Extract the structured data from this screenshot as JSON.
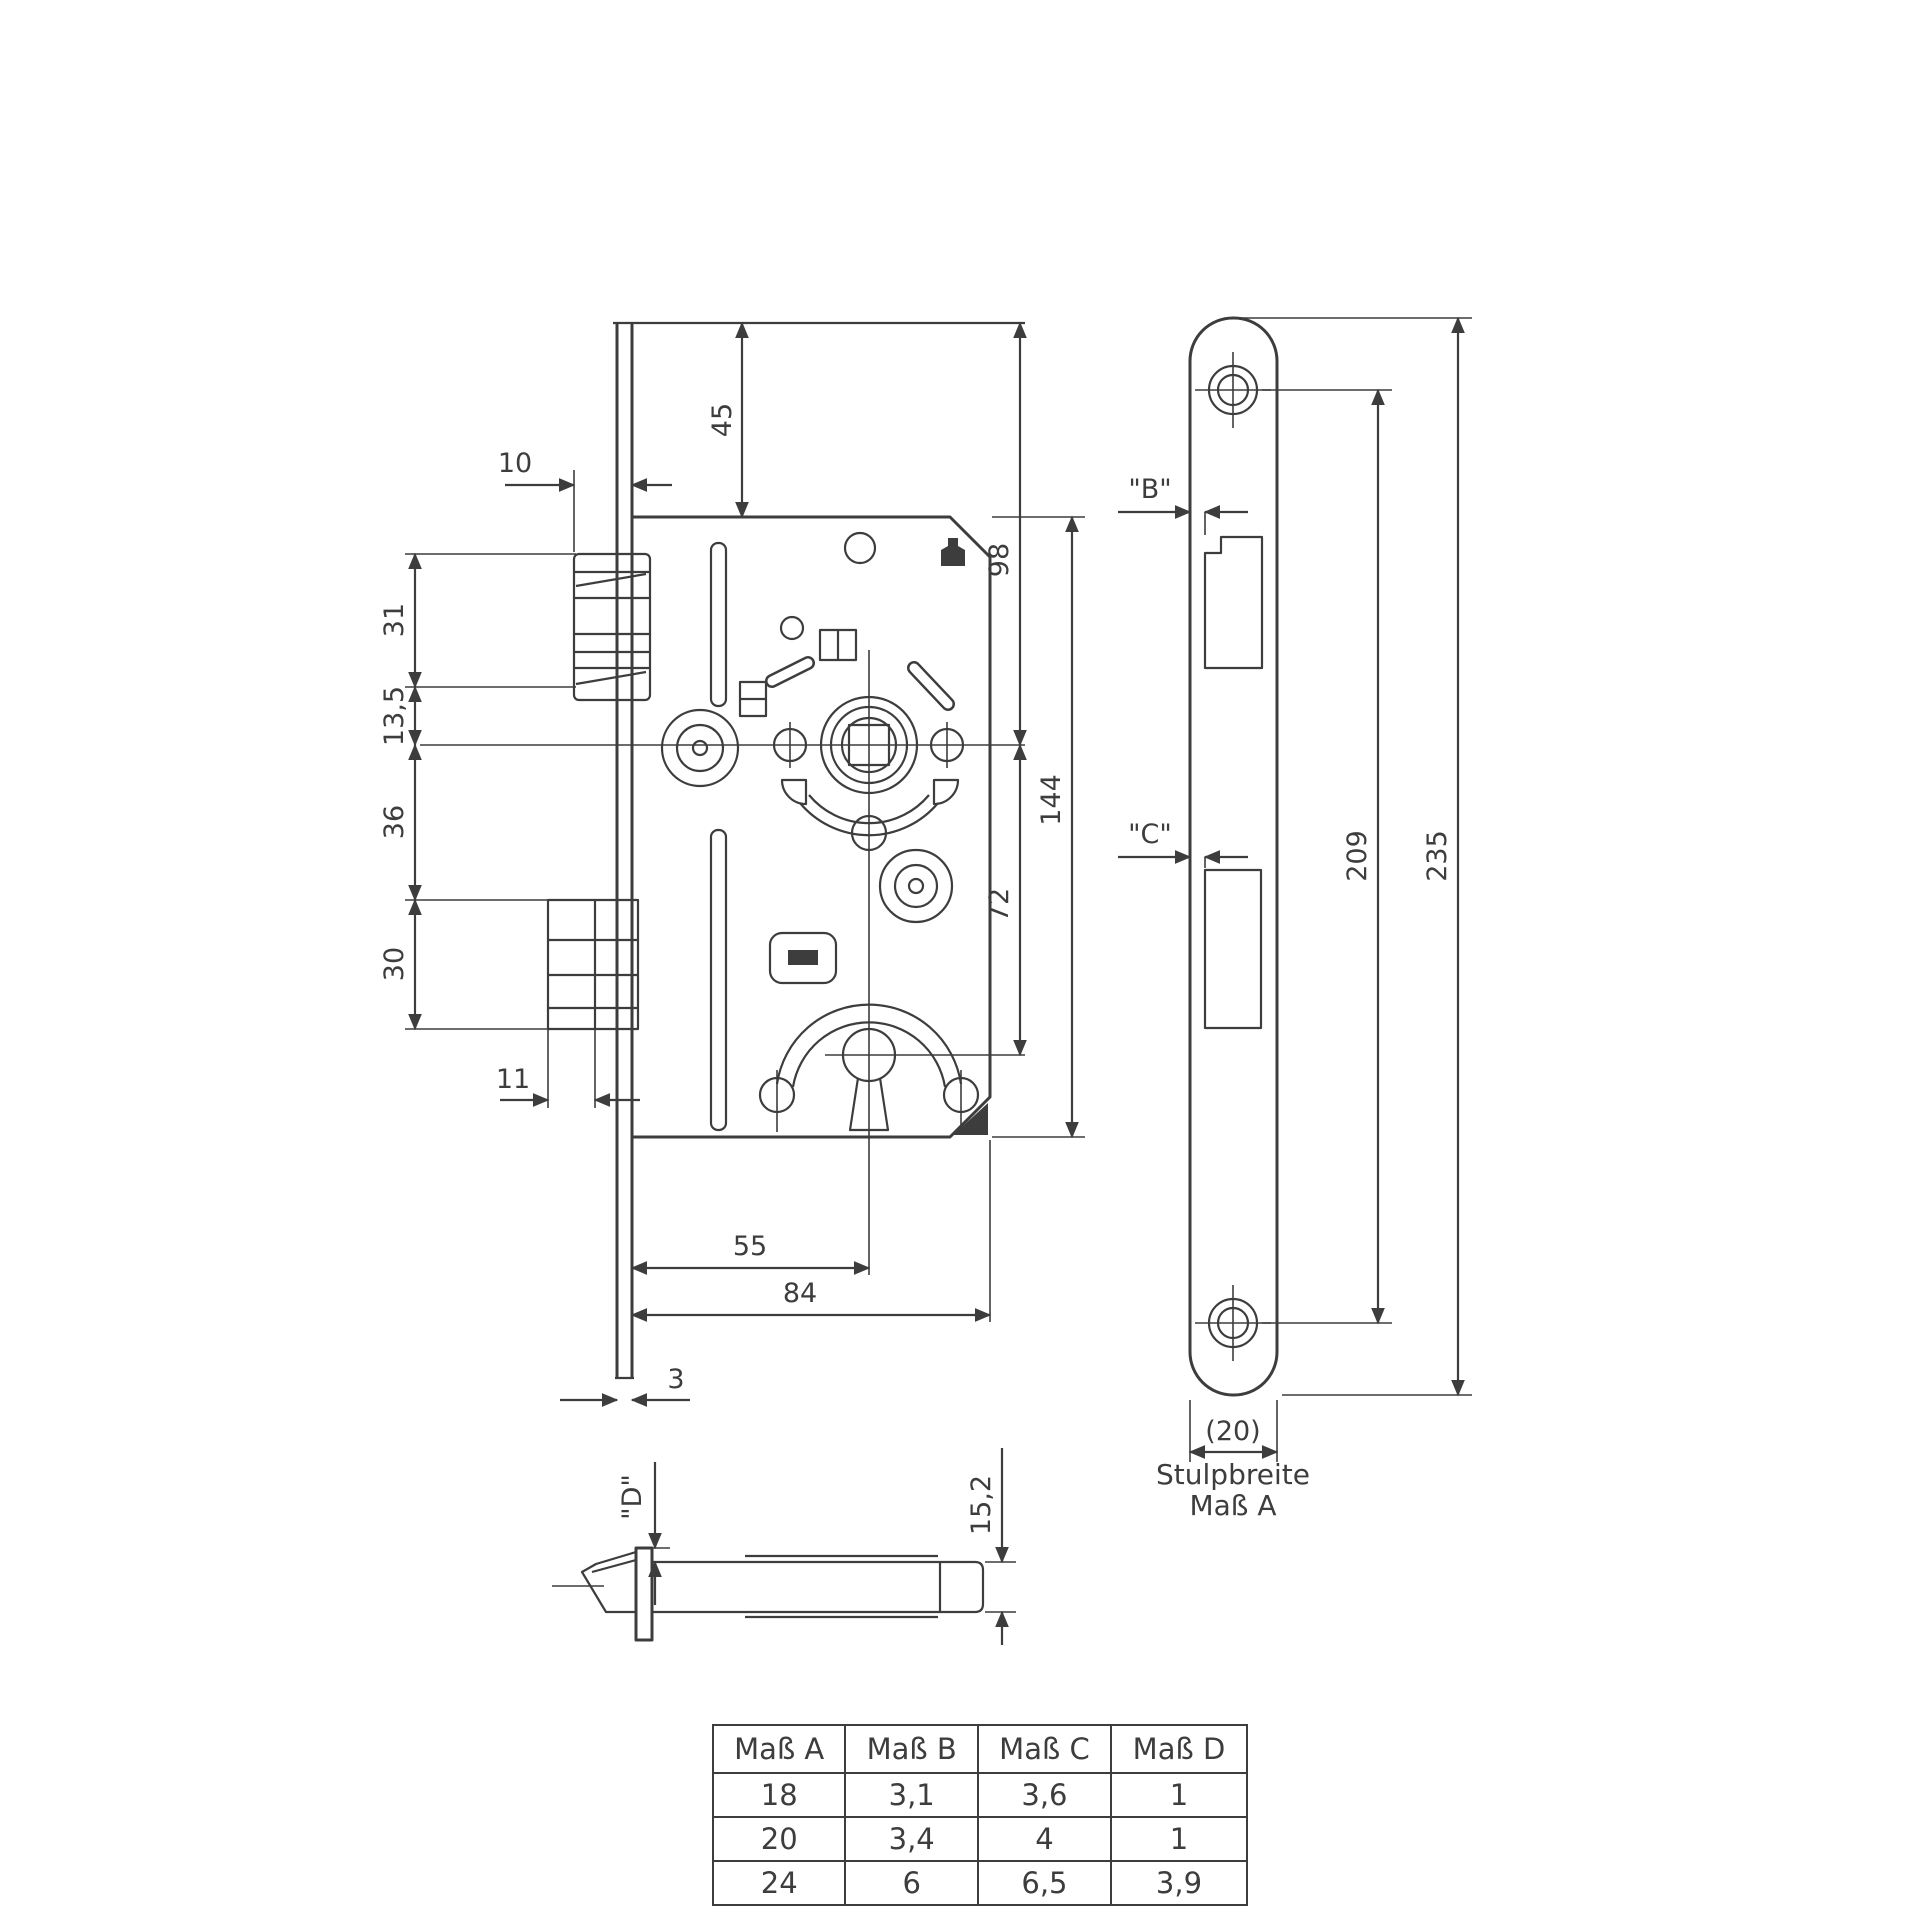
{
  "colors": {
    "line": "#3d3d3d",
    "background": "#ffffff"
  },
  "front_view": {
    "dims": {
      "plate_top_to_case": "45",
      "latch_protrusion": "10",
      "latch_height": "31",
      "latch_to_centerline": "13,5",
      "centerline_to_bolt": "36",
      "bolt_height": "30",
      "bolt_protrusion": "11",
      "plate_top_to_centerline": "98",
      "case_height": "144",
      "centerline_to_keyhole": "72",
      "backset": "55",
      "case_depth": "84",
      "plate_thickness": "3"
    }
  },
  "side_view": {
    "dims": {
      "latch_offset_label": "\"B\"",
      "bolt_offset_label": "\"C\"",
      "screw_spacing": "209",
      "plate_length": "235",
      "plate_width": "(20)"
    },
    "caption": {
      "line1": "Stulpbreite",
      "line2": "Maß A"
    }
  },
  "bottom_view": {
    "dims": {
      "offset_label": "\"D\"",
      "case_thickness": "15,2"
    }
  },
  "table": {
    "headers": [
      "Maß A",
      "Maß B",
      "Maß C",
      "Maß D"
    ],
    "rows": [
      [
        "18",
        "3,1",
        "3,6",
        "1"
      ],
      [
        "20",
        "3,4",
        "4",
        "1"
      ],
      [
        "24",
        "6",
        "6,5",
        "3,9"
      ]
    ]
  }
}
